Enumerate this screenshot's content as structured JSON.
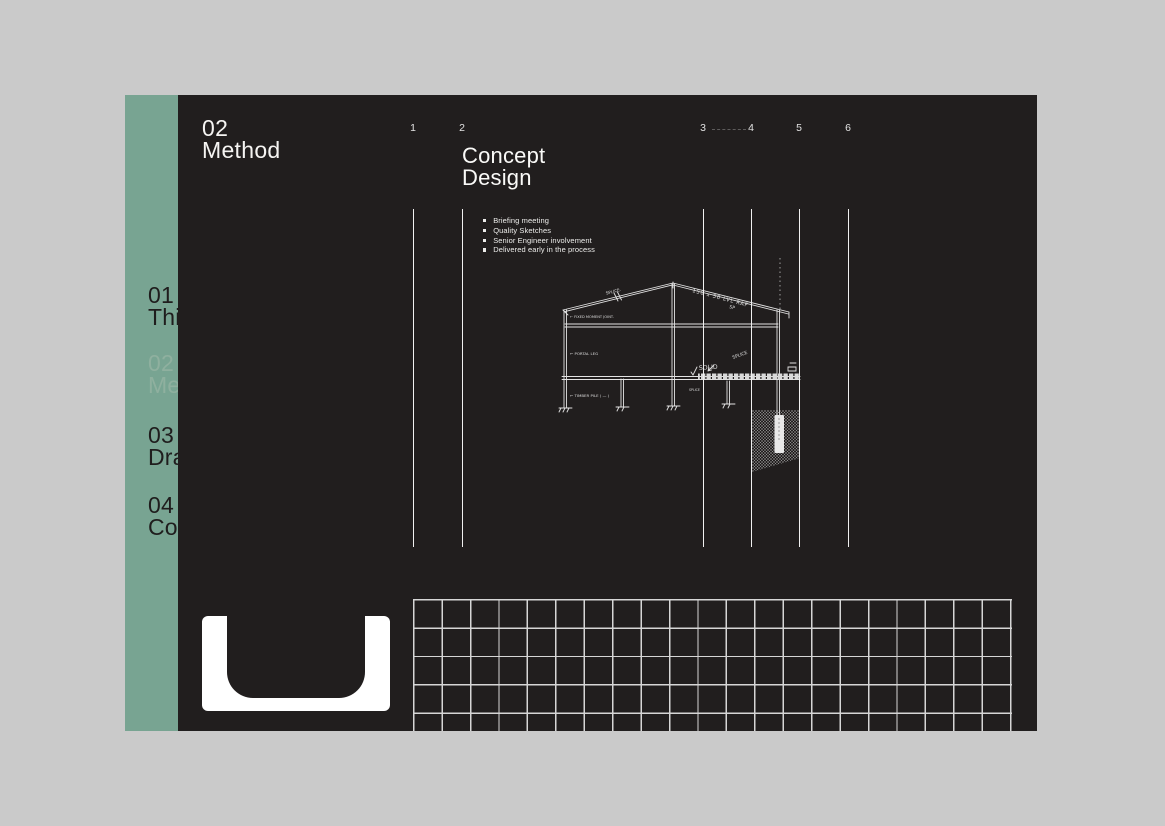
{
  "colors": {
    "canvas_bg": "#cacaca",
    "slide_bg": "#211E1E",
    "sidebar_green": "#78A492",
    "active_nav_text": "#8FB09F",
    "text_light": "#F5F4F2",
    "grid_line": "#D6D6D6"
  },
  "header": {
    "section_number": "02",
    "section_title": "Method"
  },
  "sidebar": {
    "items": [
      {
        "number": "01",
        "label": "Thi",
        "active": false
      },
      {
        "number": "02",
        "label": "Me",
        "active": true
      },
      {
        "number": "03",
        "label": "Dra",
        "active": false
      },
      {
        "number": "04",
        "label": "Co",
        "active": false
      }
    ]
  },
  "stages": {
    "numbers": [
      "1",
      "2",
      "3",
      "4",
      "5",
      "6"
    ]
  },
  "content": {
    "title_line1": "Concept",
    "title_line2": "Design",
    "bullets": [
      "Briefing meeting",
      "Quality Sketches",
      "Senior Engineer involvement",
      "Delivered early in the process"
    ]
  },
  "sketch": {
    "annotations": {
      "splice_left": "SPLICE.",
      "rafter": "150 x 50 LVL RAF",
      "sp": "SP",
      "moment_joint": "← FIXED MOMENT JOINT.",
      "portal_leg": "← PORTAL LEG",
      "solid": "SOLID",
      "splice_right": "SPLICE",
      "splice_low": "SPLICE",
      "timber_pile": "← TIMBER PILE ( — )"
    }
  }
}
